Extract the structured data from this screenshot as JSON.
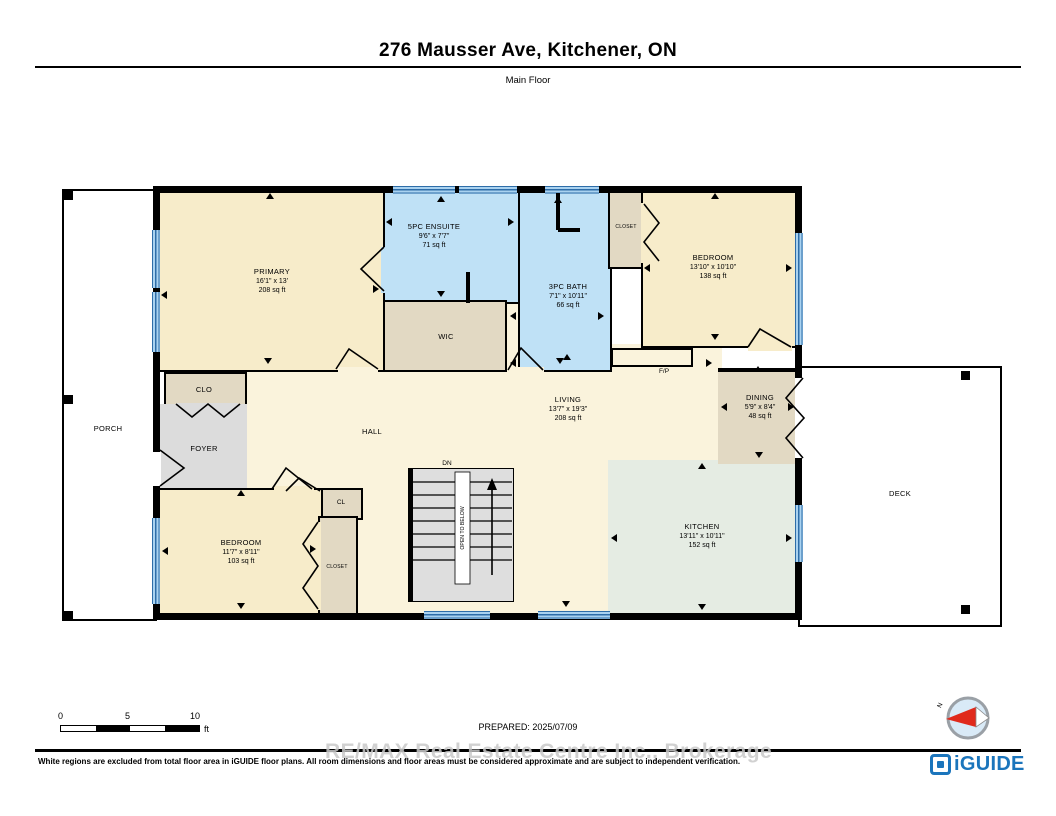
{
  "header": {
    "title": "276 Mausser Ave, Kitchener, ON",
    "subtitle": "Main Floor"
  },
  "rooms": {
    "primary": {
      "name": "PRIMARY",
      "dims": "16'1\" x 13'",
      "area": "208 sq ft"
    },
    "ensuite": {
      "name": "5PC ENSUITE",
      "dims": "9'6\" x 7'7\"",
      "area": "71 sq ft"
    },
    "bath": {
      "name": "3PC BATH",
      "dims": "7'1\" x 10'11\"",
      "area": "66 sq ft"
    },
    "closet_top": {
      "name": "CLOSET"
    },
    "bedroom_tr": {
      "name": "BEDROOM",
      "dims": "13'10\" x 10'10\"",
      "area": "138 sq ft"
    },
    "wic": {
      "name": "WIC"
    },
    "living": {
      "name": "LIVING",
      "dims": "13'7\" x 19'3\"",
      "area": "208 sq ft"
    },
    "dining": {
      "name": "DINING",
      "dims": "5'9\" x 8'4\"",
      "area": "48 sq ft"
    },
    "hall": {
      "name": "HALL"
    },
    "foyer": {
      "name": "FOYER"
    },
    "clo": {
      "name": "CLO"
    },
    "cl": {
      "name": "CL"
    },
    "bedroom_bl": {
      "name": "BEDROOM",
      "dims": "11'7\" x 8'11\"",
      "area": "103 sq ft"
    },
    "closet_bl": {
      "name": "CLOSET"
    },
    "kitchen": {
      "name": "KITCHEN",
      "dims": "13'11\" x 10'11\"",
      "area": "152 sq ft"
    },
    "porch": {
      "name": "PORCH"
    },
    "deck": {
      "name": "DECK"
    },
    "fireplace": {
      "name": "F/P"
    },
    "stairs": {
      "dn": "DN",
      "open": "OPEN TO BELOW"
    }
  },
  "footer": {
    "scale": {
      "t0": "0",
      "t5": "5",
      "t10": "10",
      "unit": "ft"
    },
    "prepared": "PREPARED: 2025/07/09",
    "watermark": "RE/MAX Real Estate Centre Inc., Brokerage",
    "disclaimer": "White regions are excluded from total floor area in iGUIDE floor plans. All room dimensions and floor areas must be considered approximate and are subject to independent verification.",
    "brand": "iGUIDE",
    "compass_north": "N"
  },
  "colors": {
    "wall": "#000000",
    "room_cream": "#F7ECCA",
    "room_cream_light": "#FAF3DC",
    "room_blue": "#BFE1F6",
    "room_tan": "#E2D9C3",
    "room_gray": "#DCDCDC",
    "room_green": "#E5ECE3",
    "stairs_gray": "#DEDEDE",
    "window_light": "#A9D2F0",
    "window_dark": "#2E6DA8",
    "brand_blue": "#1B75BC",
    "compass_red": "#E02A1C",
    "watermark_gray": "#C9C9C9"
  }
}
